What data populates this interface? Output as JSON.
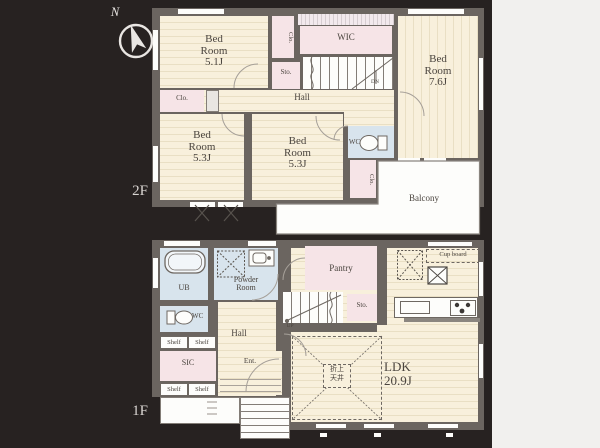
{
  "palette": {
    "background": "#272221",
    "panel_light": "#f1f0ee",
    "wall": "#6b6560",
    "room_cream": "#f8f0dc",
    "room_pink": "#f6e4e7",
    "room_blue": "#d8e4ed",
    "text": "#4a443e",
    "floor_label_text": "#d9d5d2"
  },
  "compass": {
    "north_label": "N"
  },
  "floor2": {
    "floor_label": "2F",
    "bedroom_51": [
      "Bed",
      "Room",
      "5.1J"
    ],
    "closet_top": "Clo.",
    "wic": "WIC",
    "storage": "Sto.",
    "stairs_down": "DN",
    "bedroom_76": [
      "Bed",
      "Room",
      "7.6J"
    ],
    "closet_left": "Clo.",
    "hall": "Hall",
    "bedroom_53_left": [
      "Bed",
      "Room",
      "5.3J"
    ],
    "bedroom_53_center": [
      "Bed",
      "Room",
      "5.3J"
    ],
    "wc": "WC",
    "closet_right": "Clo.",
    "balcony": "Balcony"
  },
  "floor1": {
    "floor_label": "1F",
    "unit_bath": "UB",
    "powder_room": [
      "Powder",
      "Room"
    ],
    "pantry": "Pantry",
    "storage": "Sto.",
    "stairs_up": "UP",
    "wc": "WC",
    "shelf_row_upper": [
      "Shelf",
      "Shelf"
    ],
    "shelf_row_lower": [
      "Shelf",
      "Shelf"
    ],
    "hall": "Hall",
    "sic": "SIC",
    "entrance": "Ent.",
    "cup_board": "Cup board",
    "ldk": [
      "LDK",
      "20.9J"
    ],
    "raised_ceiling": [
      "折上",
      "天井"
    ]
  }
}
